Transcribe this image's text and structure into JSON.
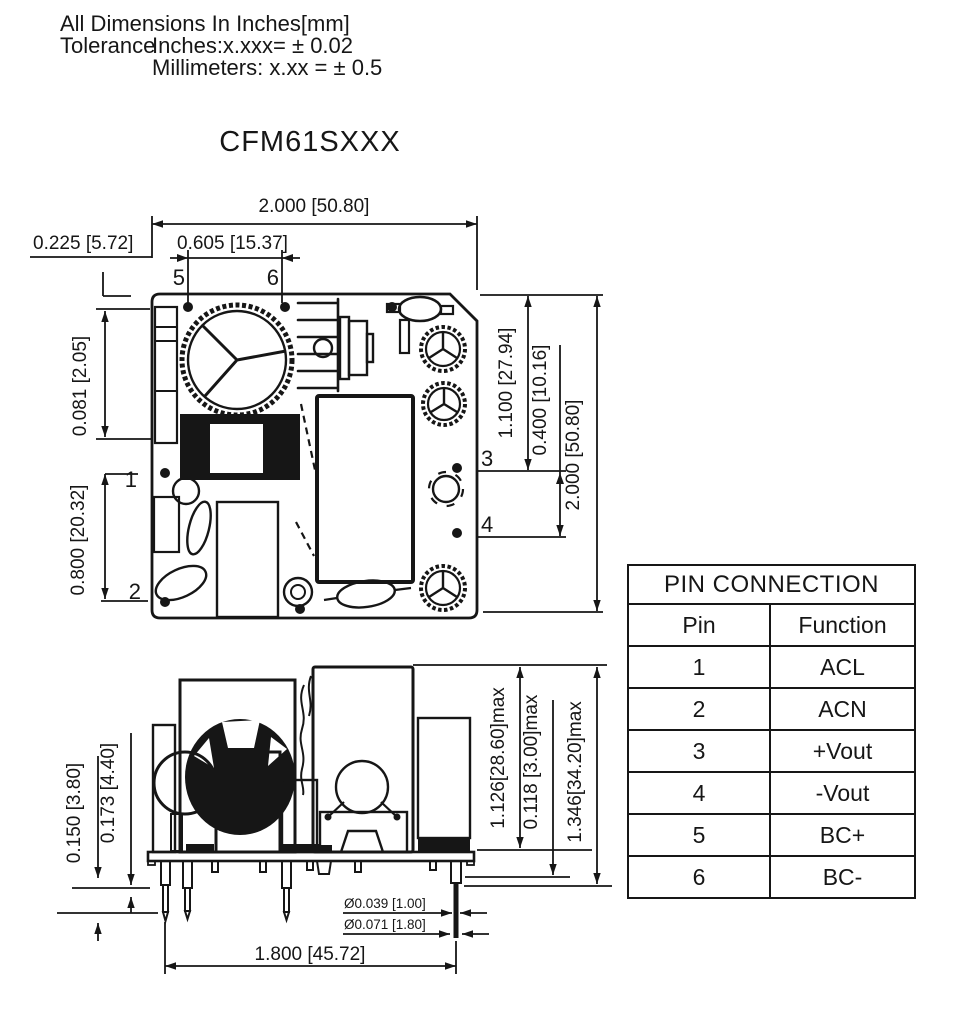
{
  "colors": {
    "ink": "#161616",
    "background": "#ffffff"
  },
  "header": {
    "line1": "All Dimensions In Inches[mm]",
    "tolerance_label": "Tolerance",
    "tolerance_inches": "Inches:x.xxx= ± 0.02",
    "tolerance_mm": "Millimeters: x.xx = ± 0.5"
  },
  "title": "CFM61SXXX",
  "top_view": {
    "dim_width_top": "2.000 [50.80]",
    "dim_left_offset": "0.225 [5.72]",
    "dim_pin5_pin6": "0.605 [15.37]",
    "dim_left_upper": "0.081 [2.05]",
    "dim_left_lower": "0.800 [20.32]",
    "dim_right_inner": "1.100 [27.94]",
    "dim_right_mid": "0.400 [10.16]",
    "dim_right_outer": "2.000 [50.80]",
    "pin_labels": {
      "p1": "1",
      "p2": "2",
      "p3": "3",
      "p4": "4",
      "p5": "5",
      "p6": "6"
    }
  },
  "side_view": {
    "dim_left_outer": "0.150 [3.80]",
    "dim_left_inner": "0.173 [4.40]",
    "dim_height_body": "1.126[28.60]max",
    "dim_standoff": "0.118 [3.00]max",
    "dim_height_total": "1.346[34.20]max",
    "dim_pin_dia_1": "Ø0.039 [1.00]",
    "dim_pin_dia_2": "Ø0.071 [1.80]",
    "dim_pin_span": "1.800 [45.72]"
  },
  "pin_table": {
    "title": "PIN CONNECTION",
    "columns": {
      "pin": "Pin",
      "function": "Function"
    },
    "rows": [
      {
        "pin": "1",
        "function": "ACL"
      },
      {
        "pin": "2",
        "function": "ACN"
      },
      {
        "pin": "3",
        "function": "+Vout"
      },
      {
        "pin": "4",
        "function": "-Vout"
      },
      {
        "pin": "5",
        "function": "BC+"
      },
      {
        "pin": "6",
        "function": "BC-"
      }
    ]
  }
}
